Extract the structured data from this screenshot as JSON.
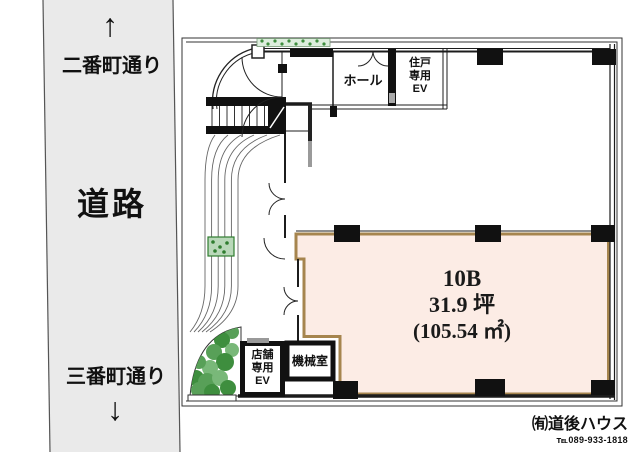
{
  "road": {
    "label": "道路",
    "top_street": {
      "label": "二番町通り",
      "direction": "up"
    },
    "bottom_street": {
      "label": "三番町通り",
      "direction": "down"
    }
  },
  "icons": {
    "north_arrow": "↑",
    "south_arrow": "↓"
  },
  "plan": {
    "rooms": {
      "hall": {
        "label": "ホール"
      },
      "residential_ev": {
        "label": "住戸\n専用\nEV"
      },
      "shop_ev": {
        "label": "店舗\n専用\nEV"
      },
      "machine": {
        "label": "機械室"
      }
    },
    "unit": {
      "name": "10B",
      "area_tsubo": "31.9 坪",
      "area_sqm": "(105.54 ㎡)"
    }
  },
  "footer": {
    "company": "㈲道後ハウス",
    "tel": "℡089-933-1818"
  },
  "colors": {
    "road_fill": "#eaeaea",
    "line": "#1c1c1c",
    "unit_fill": "#fcece5",
    "unit_border": "#a6854e",
    "green_dark": "#3e8e3e",
    "green_mid": "#58a058",
    "green_light": "#79b879",
    "window_gray": "#9a9a9a"
  }
}
